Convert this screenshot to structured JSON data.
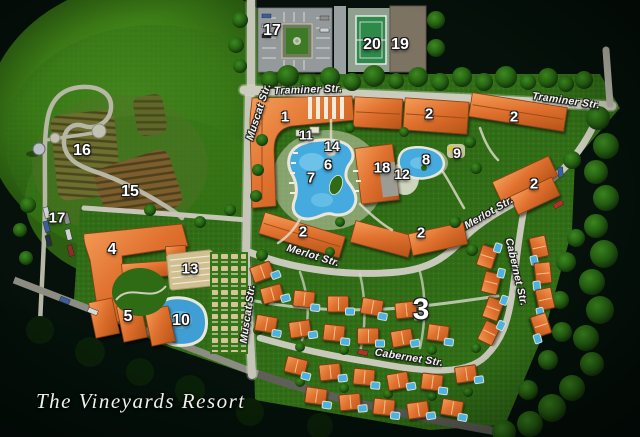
{
  "title": "The Vineyards Resort",
  "colors": {
    "background_dark": "#05110a",
    "field_green": "#3e7f17",
    "lawn_green": "#316d17",
    "building_orange": "#e0712f",
    "pool_blue": "#45aadd",
    "road_gray": "#c9c9bb",
    "tennis_green": "#2f8a4c",
    "parking_gray": "#94999b",
    "label_white": "#ffffff"
  },
  "street_labels": [
    {
      "text": "Traminer Str.",
      "x": 308,
      "y": 90,
      "rot": -2
    },
    {
      "text": "Traminer Str.",
      "x": 566,
      "y": 101,
      "rot": 8
    },
    {
      "text": "Muscat Str.",
      "x": 259,
      "y": 112,
      "rot": -72
    },
    {
      "text": "Muscat Str.",
      "x": 248,
      "y": 314,
      "rot": -82
    },
    {
      "text": "Merlot Str.",
      "x": 313,
      "y": 256,
      "rot": 17
    },
    {
      "text": "Merlot Str.",
      "x": 489,
      "y": 213,
      "rot": -30
    },
    {
      "text": "Cabernet Str.",
      "x": 409,
      "y": 358,
      "rot": 9
    },
    {
      "text": "Cabernet Str.",
      "x": 516,
      "y": 272,
      "rot": 77
    }
  ],
  "map_labels": [
    {
      "text": "16",
      "x": 82,
      "y": 151,
      "size": 16
    },
    {
      "text": "15",
      "x": 130,
      "y": 192,
      "size": 16
    },
    {
      "text": "17",
      "x": 272,
      "y": 31,
      "size": 16
    },
    {
      "text": "20",
      "x": 372,
      "y": 45,
      "size": 16
    },
    {
      "text": "19",
      "x": 400,
      "y": 45,
      "size": 16
    },
    {
      "text": "17",
      "x": 57,
      "y": 218,
      "size": 15
    },
    {
      "text": "4",
      "x": 112,
      "y": 250,
      "size": 16
    },
    {
      "text": "13",
      "x": 190,
      "y": 269,
      "size": 15
    },
    {
      "text": "5",
      "x": 128,
      "y": 317,
      "size": 16
    },
    {
      "text": "10",
      "x": 181,
      "y": 321,
      "size": 16
    },
    {
      "text": "1",
      "x": 285,
      "y": 117,
      "size": 15
    },
    {
      "text": "11",
      "x": 306,
      "y": 135,
      "size": 13
    },
    {
      "text": "14",
      "x": 332,
      "y": 146,
      "size": 14
    },
    {
      "text": "6",
      "x": 328,
      "y": 165,
      "size": 15
    },
    {
      "text": "7",
      "x": 311,
      "y": 178,
      "size": 15
    },
    {
      "text": "18",
      "x": 382,
      "y": 168,
      "size": 15
    },
    {
      "text": "12",
      "x": 402,
      "y": 174,
      "size": 14
    },
    {
      "text": "8",
      "x": 426,
      "y": 160,
      "size": 15
    },
    {
      "text": "9",
      "x": 457,
      "y": 153,
      "size": 14
    },
    {
      "text": "2",
      "x": 429,
      "y": 114,
      "size": 15
    },
    {
      "text": "2",
      "x": 514,
      "y": 117,
      "size": 15
    },
    {
      "text": "2",
      "x": 534,
      "y": 184,
      "size": 15
    },
    {
      "text": "2",
      "x": 303,
      "y": 232,
      "size": 15
    },
    {
      "text": "2",
      "x": 421,
      "y": 233,
      "size": 15
    },
    {
      "text": "3",
      "x": 421,
      "y": 310,
      "size": 30
    }
  ],
  "villas": [
    {
      "x": 262,
      "y": 272,
      "rot": -20
    },
    {
      "x": 272,
      "y": 294,
      "rot": -15
    },
    {
      "x": 304,
      "y": 299,
      "rot": 6
    },
    {
      "x": 338,
      "y": 304,
      "rot": 0
    },
    {
      "x": 372,
      "y": 307,
      "rot": 10
    },
    {
      "x": 406,
      "y": 310,
      "rot": -6
    },
    {
      "x": 266,
      "y": 324,
      "rot": 10
    },
    {
      "x": 300,
      "y": 329,
      "rot": -8
    },
    {
      "x": 334,
      "y": 333,
      "rot": 6
    },
    {
      "x": 368,
      "y": 336,
      "rot": 0
    },
    {
      "x": 402,
      "y": 338,
      "rot": -10
    },
    {
      "x": 438,
      "y": 333,
      "rot": 8
    },
    {
      "x": 296,
      "y": 366,
      "rot": 14
    },
    {
      "x": 330,
      "y": 372,
      "rot": -6
    },
    {
      "x": 364,
      "y": 377,
      "rot": 5
    },
    {
      "x": 398,
      "y": 381,
      "rot": -10
    },
    {
      "x": 432,
      "y": 382,
      "rot": 7
    },
    {
      "x": 466,
      "y": 374,
      "rot": -8
    },
    {
      "x": 316,
      "y": 396,
      "rot": 8
    },
    {
      "x": 350,
      "y": 402,
      "rot": -5
    },
    {
      "x": 384,
      "y": 407,
      "rot": 6
    },
    {
      "x": 418,
      "y": 410,
      "rot": -8
    },
    {
      "x": 452,
      "y": 408,
      "rot": 10
    },
    {
      "x": 539,
      "y": 247,
      "rot": 78
    },
    {
      "x": 543,
      "y": 273,
      "rot": 84
    },
    {
      "x": 545,
      "y": 299,
      "rot": 78
    },
    {
      "x": 541,
      "y": 325,
      "rot": 72
    },
    {
      "x": 487,
      "y": 257,
      "rot": -72
    },
    {
      "x": 491,
      "y": 283,
      "rot": -76
    },
    {
      "x": 493,
      "y": 309,
      "rot": -70
    },
    {
      "x": 489,
      "y": 333,
      "rot": -64
    }
  ]
}
